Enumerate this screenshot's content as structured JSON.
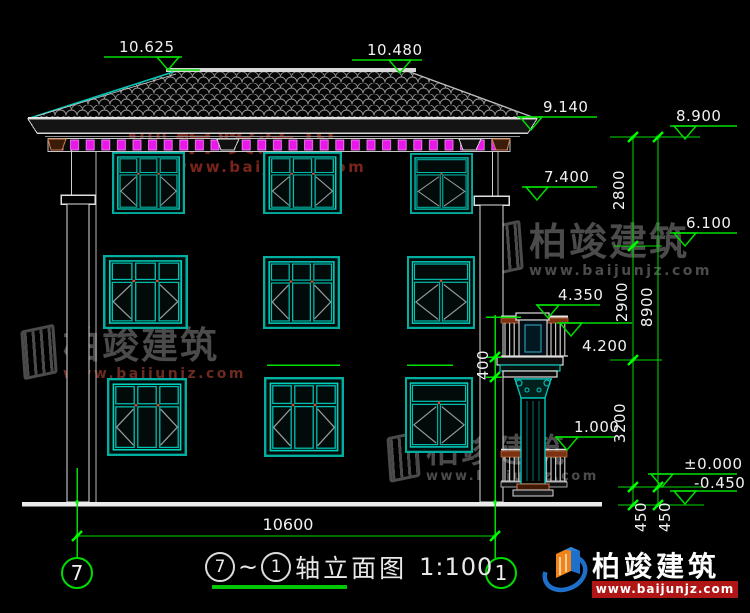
{
  "drawing": {
    "title": {
      "axis_start": "7",
      "separator": "~",
      "axis_end": "1",
      "name": "轴立面图",
      "scale": "1:100"
    },
    "axis_bubbles": {
      "left": "7",
      "right": "1"
    },
    "elevation_labels": {
      "ridge_left": "10.625",
      "ridge_right": "10.480",
      "eave": "9.140",
      "wall_top": "8.900",
      "floor3": "7.400",
      "level_6100": "6.100",
      "balcony_rail": "4.350",
      "balcony_floor": "4.200",
      "porch_rail": "1.000",
      "zero": "±0.000",
      "site": "-0.450"
    },
    "dimensions": {
      "v2800": "2800",
      "v2900": "2900",
      "v3200": "3200",
      "v8900": "8900",
      "v450_inner": "450",
      "v450_outer": "450",
      "v400": "400",
      "total_width": "10600"
    }
  },
  "watermark": {
    "brand": "柏竣建筑",
    "site": "www.baijunjz.com"
  },
  "logo": {
    "brand": "柏竣建筑",
    "site": "www.baijunjz.com"
  },
  "colors": {
    "background": "#000000",
    "cad_green": "#00dd00",
    "cad_cyan": "#00b4a6",
    "dentil_magenta": "#e818e8",
    "text_white": "#f2f2f2",
    "watermark_red": "#8a2a1e",
    "watermark_gray": "#565656",
    "logo_red_bar": "#b01616"
  }
}
